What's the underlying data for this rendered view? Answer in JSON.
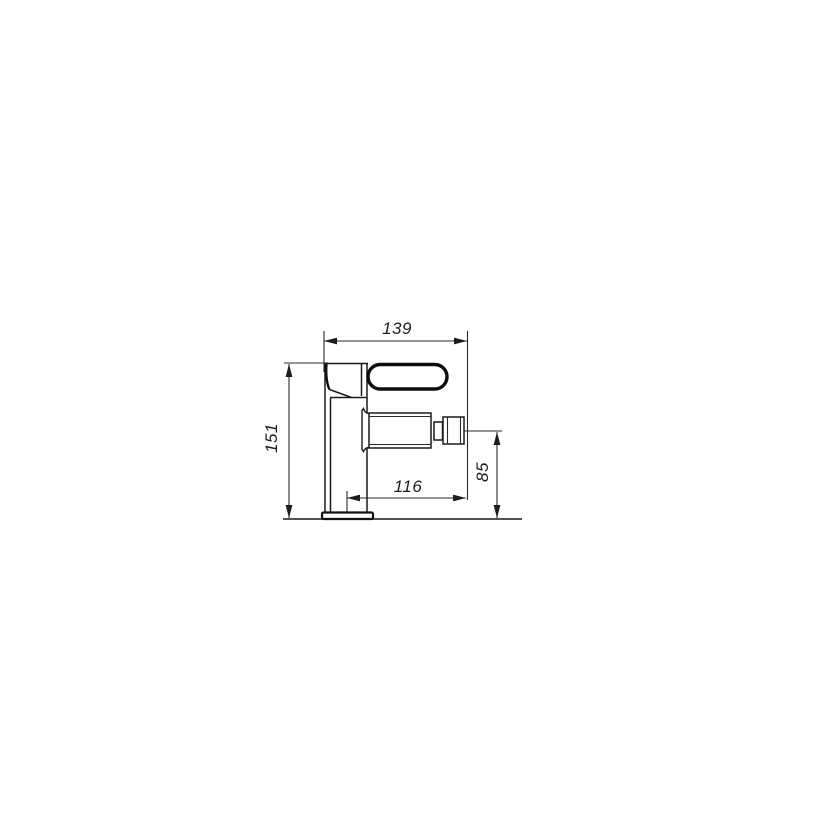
{
  "drawing": {
    "name": "single-lever-bidet-mixer-technical-drawing",
    "background_color": "#ffffff",
    "line_color": "#1a1a1a",
    "dimensions": {
      "overall_width": "139",
      "overall_height": "151",
      "spout_reach": "116",
      "spout_outlet_height": "85"
    }
  }
}
